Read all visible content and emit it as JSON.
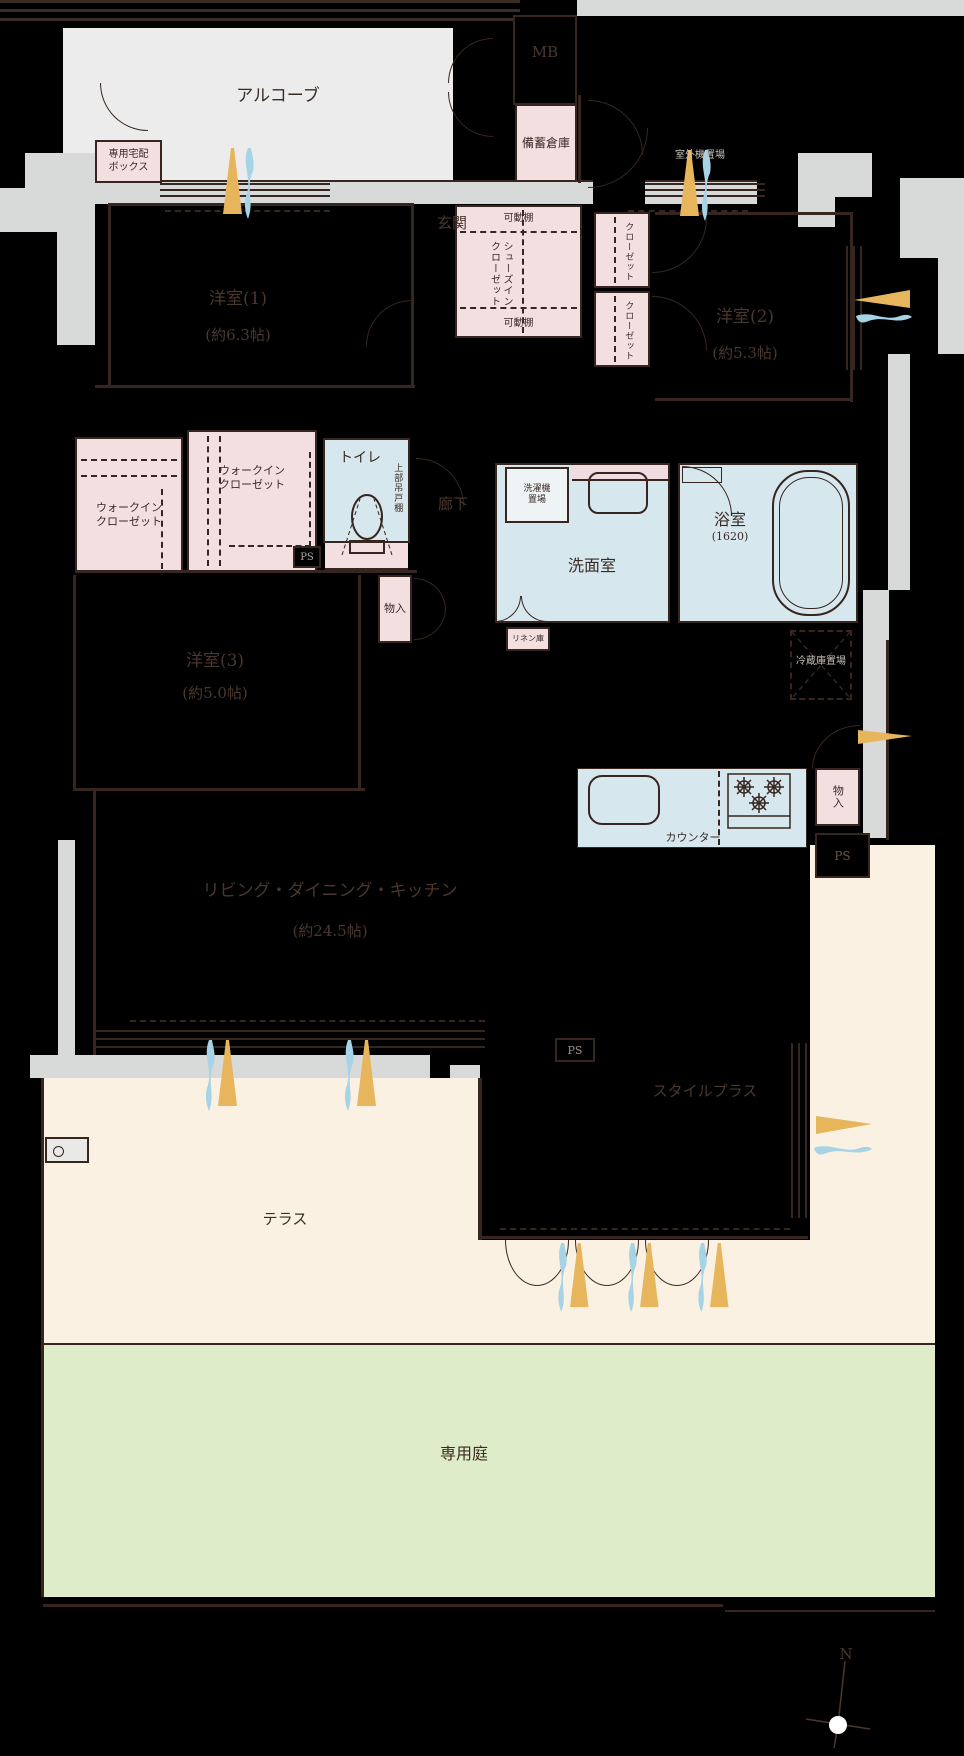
{
  "plan_type": "apartment-floor-plan",
  "colors": {
    "background": "#000000",
    "wall_line": "#36261f",
    "common_area_gray": "#d8dad9",
    "alcove_gray": "#ececec",
    "closet_pink": "#f3dee0",
    "wet_area_blue": "#d7e7ee",
    "terrace_cream": "#faf1e2",
    "garden_green": "#dfecca",
    "arrow_yellow": "#e6b55c",
    "arrow_blue": "#a6d3e6",
    "room_label_dark": "#4a372e",
    "label_light": "#c6c0b8"
  },
  "labels": {
    "alcove": "アルコーブ",
    "mb": "MB",
    "bichiku": "備蓄倉庫",
    "delivery_box": "専用宅配\nボックス",
    "genkan": "玄関",
    "kadou_top": "可動棚",
    "kadou_bottom": "可動棚",
    "sic": "シューズイン\nクローゼット",
    "closet_a": "クローゼット",
    "closet_b": "クローゼット",
    "shitsugaiki": "室外機置場",
    "yoshitsu1": "洋室(1)",
    "yoshitsu1_size": "(約6.3帖)",
    "yoshitsu2": "洋室(2)",
    "yoshitsu2_size": "(約5.3帖)",
    "yoshitsu3": "洋室(3)",
    "yoshitsu3_size": "(約5.0帖)",
    "wic1": "ウォークイン\nクローゼット",
    "wic2": "ウォークイン\nクローゼット",
    "toilet": "トイレ",
    "joubu_tsuridana": "上部吊戸棚",
    "rouka": "廊下",
    "ps1": "PS",
    "ps2": "PS",
    "ps3": "PS",
    "monoire_hall": "物入",
    "sentakuki": "洗濯機\n置場",
    "senmen": "洗面室",
    "bath": "浴室",
    "bath_size": "(1620)",
    "linen": "リネン庫",
    "reizouko": "冷蔵庫置場",
    "counter": "カウンター",
    "monoire_kitchen": "物入",
    "ldk": "リビング・ダイニング・キッチン",
    "ldk_size": "(約24.5帖)",
    "styleplus": "スタイルプラス",
    "terrace": "テラス",
    "garden": "専用庭",
    "compass_north": "N"
  }
}
